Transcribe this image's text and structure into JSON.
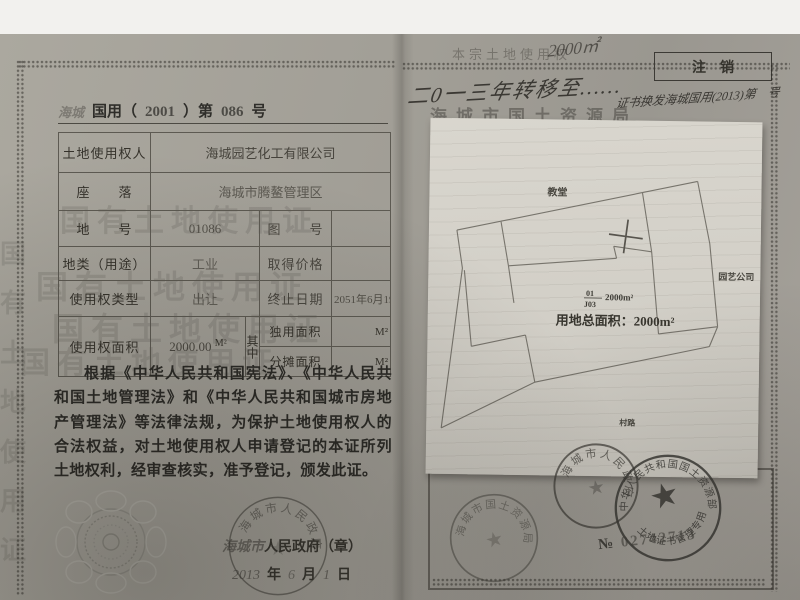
{
  "left_page": {
    "header": {
      "region_handwritten": "海城",
      "title_part1": "国用（",
      "year": "2001",
      "title_part2": "）第",
      "number": "086",
      "suffix": "号"
    },
    "table": {
      "row1_label": "土地使用权人",
      "row1_value": "海城园艺化工有限公司",
      "row2_label": "座　　落",
      "row2_value": "海城市腾鳌管理区",
      "row3_label": "地　　号",
      "row3_value": "01086",
      "row3_label2": "图　　号",
      "row3_value2": "",
      "row4_label": "地类（用途）",
      "row4_value": "工业",
      "row4_label2": "取得价格",
      "row4_value2": "",
      "row5_label": "使用权类型",
      "row5_value": "出让",
      "row5_label2": "终止日期",
      "row5_value2": "2051年6月19日",
      "row6_label": "使用权面积",
      "row6_value": "2000.00",
      "row6_value_unit": "M²",
      "row6_mid": "其中",
      "row6_sub1_label": "独用面积",
      "row6_sub1_unit": "M²",
      "row6_sub2_label": "分摊面积",
      "row6_sub2_unit": "M²"
    },
    "body_paragraph": "根据《中华人民共和国宪法》、《中华人民共和国土地管理法》和《中华人民共和国城市房地产管理法》等法律法规，为保护土地使用权人的合法权益，对土地使用权人申请登记的本证所列土地权利，经审查核实，准予登记，颁发此证。",
    "issuer_line": {
      "stamped_region": "海城市",
      "printed": "人民政府（章）",
      "year": "2013",
      "year_char": "年",
      "month": "6",
      "month_char": "月",
      "day": "1",
      "day_char": "日"
    },
    "gov_seal_ring": "海城市人民政府"
  },
  "right_page": {
    "faint_top_text": "本宗土地使用权",
    "handwritten_amount": "2000㎡",
    "handwritten_note": "二0一三年转移至……",
    "bureau_name": "海城市国土资源局",
    "cancel_box_label": "注　销",
    "cancel_note": "证书换发海城国用(2013)第　号",
    "map": {
      "label_top": "教堂",
      "label_right": "园艺公司",
      "label_road": "村路",
      "parcel_no": "01",
      "sheet_no": "J03",
      "parcel_area": "2000m²",
      "total_area": "用地总面积：2000m²"
    },
    "stamps": {
      "land_bureau_ring": "海城市国土资源局",
      "government_ring": "海城市人民政府",
      "ministry_ring": "中华人民共和国国土资源部",
      "ministry_inner": "土地证书管理专用章",
      "serial_prefix": "№",
      "serial_number": "02742713"
    }
  },
  "watermark_text": "国有土地使用证"
}
